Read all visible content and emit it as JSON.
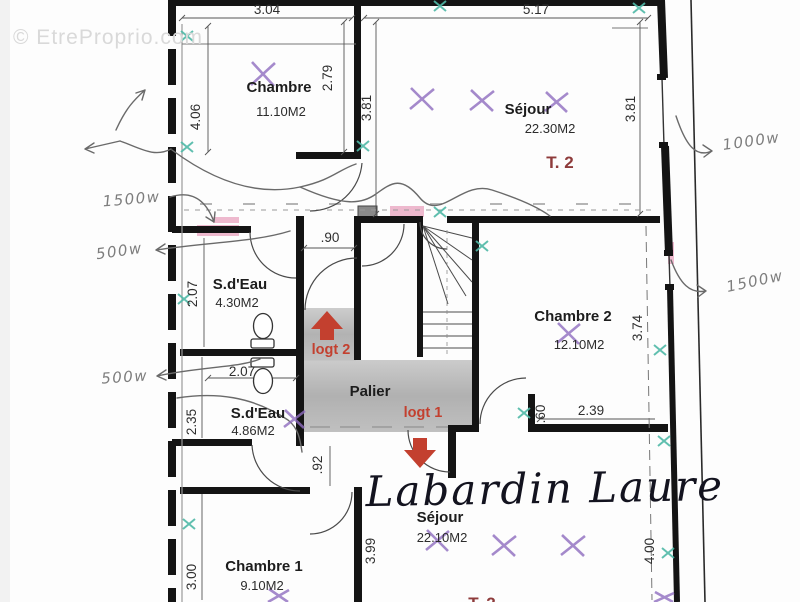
{
  "watermarks": {
    "site": "© EtreProprio.com",
    "agent": "Labardin Laure"
  },
  "rooms": {
    "chambre_top": {
      "name": "Chambre",
      "area": "11.10M2"
    },
    "sejour_top": {
      "name": "Séjour",
      "area": "22.30M2",
      "unit": "T. 2"
    },
    "sdeau_top": {
      "name": "S.d'Eau",
      "area": "4.30M2"
    },
    "chambre2": {
      "name": "Chambre 2",
      "area": "12.10M2"
    },
    "palier": {
      "name": "Palier"
    },
    "sdeau_bottom": {
      "name": "S.d'Eau",
      "area": "4.86M2"
    },
    "chambre1": {
      "name": "Chambre 1",
      "area": "9.10M2"
    },
    "sejour_bottom": {
      "name": "Séjour",
      "area": "22.10M2",
      "unit": "T. 2"
    }
  },
  "logements": {
    "logt1": "logt 1",
    "logt2": "logt 2"
  },
  "dimensions": {
    "w_chambre_top": "3.04",
    "w_sejour_top": "5.17",
    "h_chambre_right": "2.79",
    "h_chambre_left": "4.06",
    "h_sejour_left": "3.81",
    "h_sejour_right": "3.81",
    "w_passage": ".90",
    "h_sdeau_top": "2.07",
    "w_sdeau_top": "2.07",
    "h_chambre2_right": "3.74",
    "h_door_chambre2": ".60",
    "w_chambre2_bottom": "2.39",
    "h_corridor": ".92",
    "h_sdeau_bottom": "2.35",
    "h_chambre1_left": "3.00",
    "h_chambre1_right": "3.99",
    "h_sejour_bottom_right": "4.00"
  },
  "annotations": {
    "left_top": "1500w",
    "left_mid": "500w",
    "left_bottom": "500w",
    "right_top": "1000w",
    "right_mid": "1500w"
  },
  "colors": {
    "wall": "#141414",
    "unit_label": "#8e3b3b",
    "logt_red": "#c3402f",
    "pink_highlight": "#e795b6",
    "teal_mark": "#4fb8a6",
    "purple_mark": "#8f6dbf",
    "palier_gray": "#adadad",
    "pencil": "#6a6a6a",
    "dim_text": "#2f2f2f",
    "watermark": "#d9d9d9"
  }
}
